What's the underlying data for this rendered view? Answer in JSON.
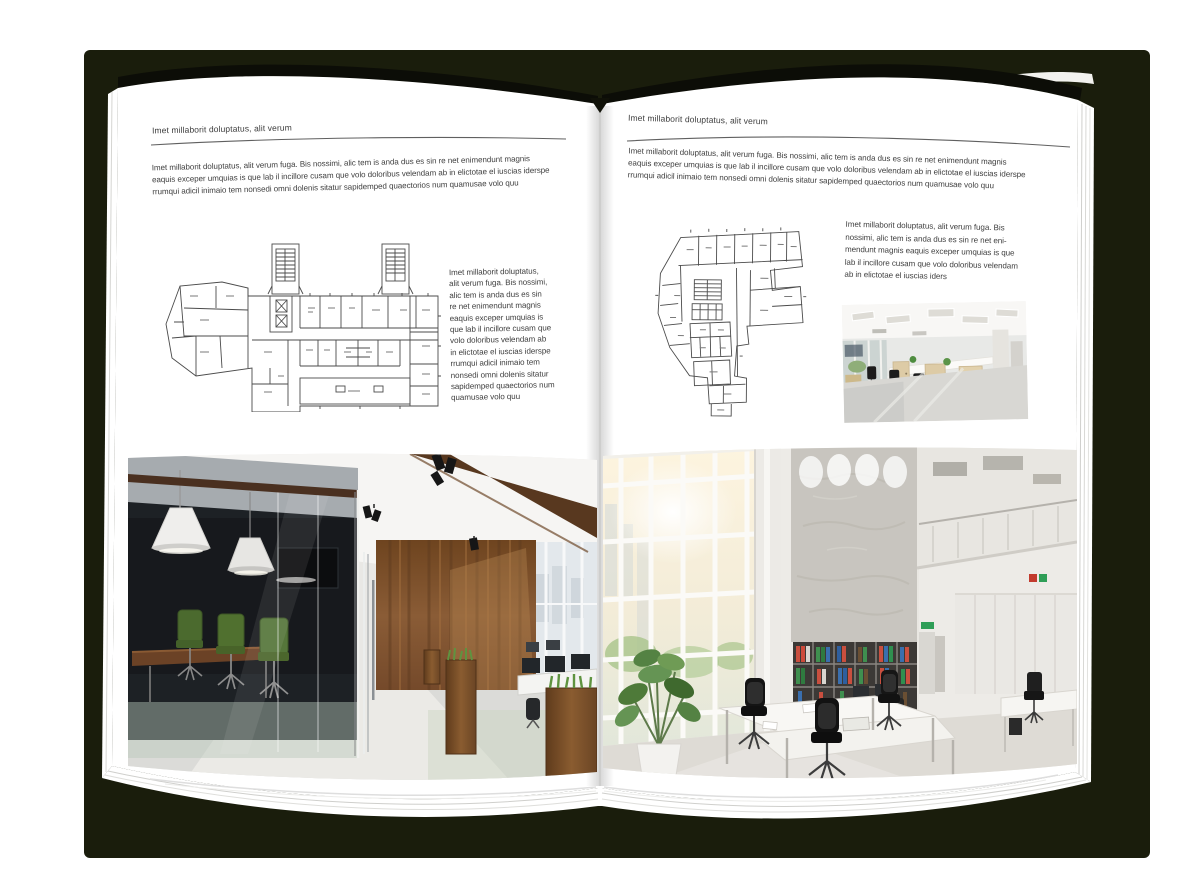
{
  "document_type": "magazine-spread-mockup",
  "colors": {
    "backdrop": "#1a1d0c",
    "page": "#ffffff",
    "text": "#3e3e3e",
    "rule": "#606060",
    "plan_line": "#4b4b4b",
    "photo_left_wood": "#7b4e2c",
    "photo_left_chair_green": "#4b6a2e",
    "photo_right_concrete": "#c8c5bf"
  },
  "left_page": {
    "header": "Imet millaborit doluptatus, alit verum",
    "intro_lines": [
      "Imet millaborit doluptatus, alit verum fuga. Bis nossimi, alic tem is anda dus es sin re net enimendunt magnis",
      "eaquis exceper umquias is que lab il incillore cusam que volo doloribus velendam ab in elictotae el iuscias iderspe",
      "rrumqui adicil inimaio tem nonsedi omni dolenis sitatur sapidemped quaectorios num quamusae volo quu"
    ],
    "caption_lines": [
      "Imet millaborit doluptatus,",
      "alit verum fuga. Bis nossimi,",
      "alic tem is anda dus es sin",
      "re net enimendunt magnis",
      "eaquis exceper umquias is",
      "que lab il incillore cusam que",
      "volo doloribus velendam ab",
      "in elictotae el iuscias iderspe",
      "rrumqui adicil inimaio tem",
      "nonsedi omni dolenis sitatur",
      "sapidemped quaectorios num",
      "quamusae volo quu"
    ]
  },
  "right_page": {
    "header": "Imet millaborit doluptatus, alit verum",
    "intro_lines": [
      "Imet millaborit doluptatus, alit verum fuga. Bis nossimi, alic tem is anda dus es sin re net enimendunt magnis",
      "eaquis exceper umquias is que lab il incillore cusam que volo doloribus velendam ab in elictotae el iuscias iderspe",
      "rrumqui adicil inimaio tem nonsedi omni dolenis sitatur sapidemped quaectorios num quamusae volo quu"
    ],
    "caption_lines": [
      "Imet millaborit doluptatus, alit verum fuga. Bis",
      "nossimi, alic tem is anda dus es sin re net eni-",
      "mendunt magnis eaquis exceper umquias is que",
      "lab il incillore cusam que volo doloribus velendam",
      "ab in elictotae el iuscias iders"
    ]
  }
}
